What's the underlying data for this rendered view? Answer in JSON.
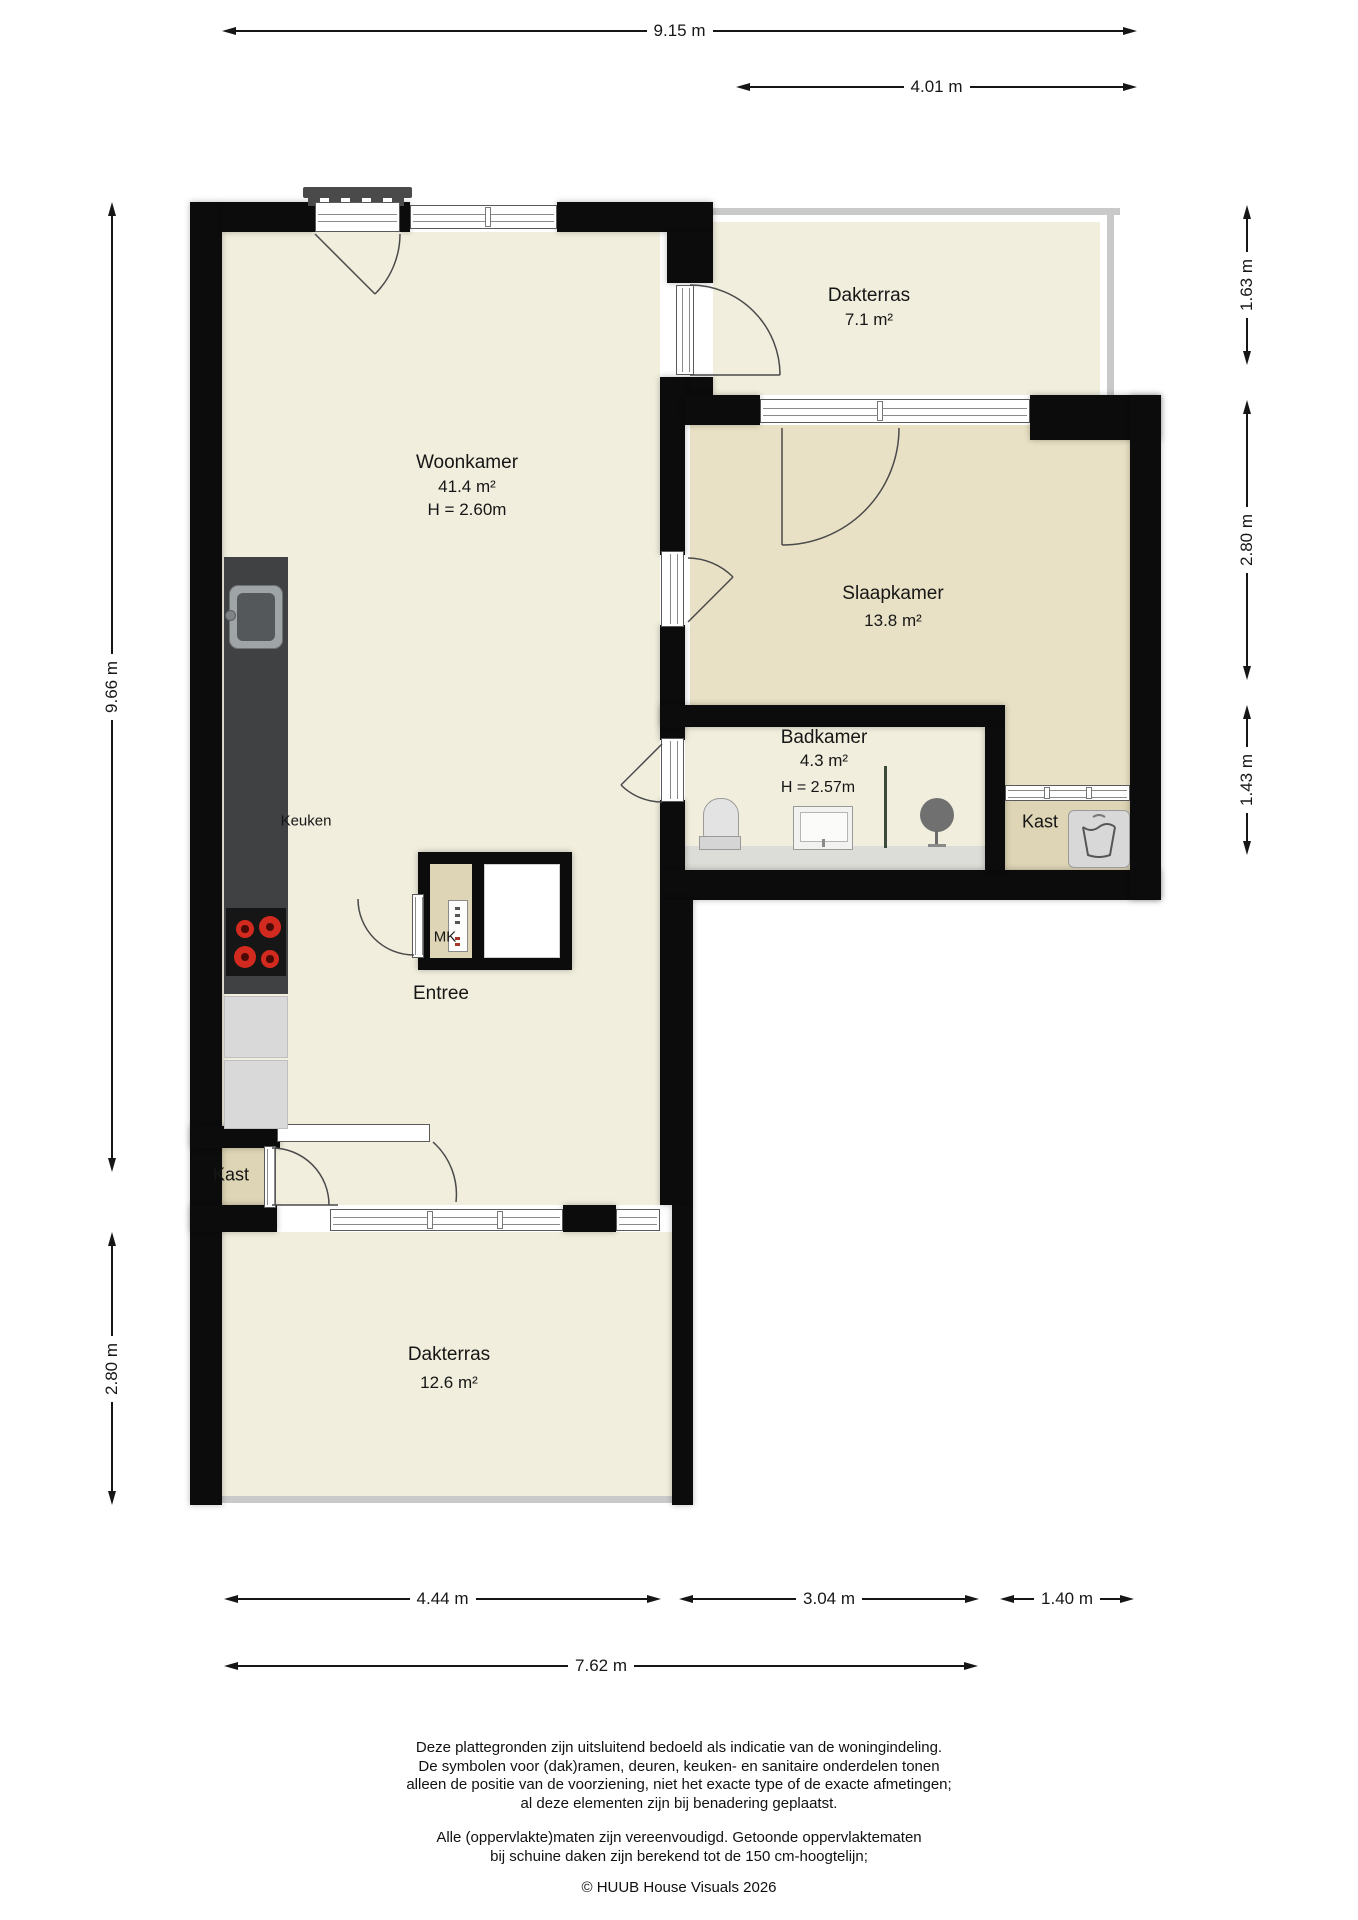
{
  "colors": {
    "wall": "#0c0c0c",
    "floor_main": "#f1eedd",
    "floor_bedroom": "#e8e1c5",
    "floor_closet": "#ddd5b5",
    "terrace_trim": "#c9c9c9",
    "burner_red": "#d22a1e",
    "text": "#161616"
  },
  "icons": {
    "kitchen_hob": "hob-4-burners-icon",
    "kitchen_sink": "kitchen-sink-icon",
    "toilet": "toilet-icon",
    "washbasin": "washbasin-icon",
    "shower": "shower-head-icon",
    "washing_machine": "washing-machine-icon",
    "meter_cupboard": "electrical-panel-icon",
    "roof_vent": "roof-window-vent-icon"
  },
  "rooms": {
    "woonkamer": {
      "name": "Woonkamer",
      "area": "41.4 m²",
      "height": "H = 2.60m"
    },
    "dakterras_top": {
      "name": "Dakterras",
      "area": "7.1 m²"
    },
    "slaapkamer": {
      "name": "Slaapkamer",
      "area": "13.8 m²"
    },
    "badkamer": {
      "name": "Badkamer",
      "area": "4.3 m²",
      "height": "H = 2.57m"
    },
    "kast_rechts": {
      "name": "Kast"
    },
    "kast_links": {
      "name": "Kast"
    },
    "keuken": {
      "name": "Keuken"
    },
    "mk": {
      "name": "MK"
    },
    "entree": {
      "name": "Entree"
    },
    "dakterras_onder": {
      "name": "Dakterras",
      "area": "12.6 m²"
    }
  },
  "dimensions": {
    "top_total": "9.15 m",
    "top_terrace": "4.01 m",
    "right": [
      "1.63 m",
      "2.80 m",
      "1.43 m"
    ],
    "left": [
      "9.66 m",
      "2.80 m"
    ],
    "bottom": [
      "4.44 m",
      "3.04 m",
      "1.40 m"
    ],
    "bottom_total": "7.62 m"
  },
  "footer": {
    "disclaimer": [
      "Deze plattegronden zijn uitsluitend bedoeld als indicatie van de woningindeling.",
      "De symbolen voor (dak)ramen, deuren, keuken- en sanitaire onderdelen tonen",
      "alleen de positie van de voorziening, niet het exacte type of de exacte afmetingen;",
      "al deze elementen zijn bij benadering geplaatst."
    ],
    "note": [
      "Alle (oppervlakte)maten zijn vereenvoudigd. Getoonde oppervlaktematen",
      "bij schuine daken zijn berekend tot de 150 cm-hoogtelijn;"
    ],
    "credit": "© HUUB House Visuals 2026"
  }
}
